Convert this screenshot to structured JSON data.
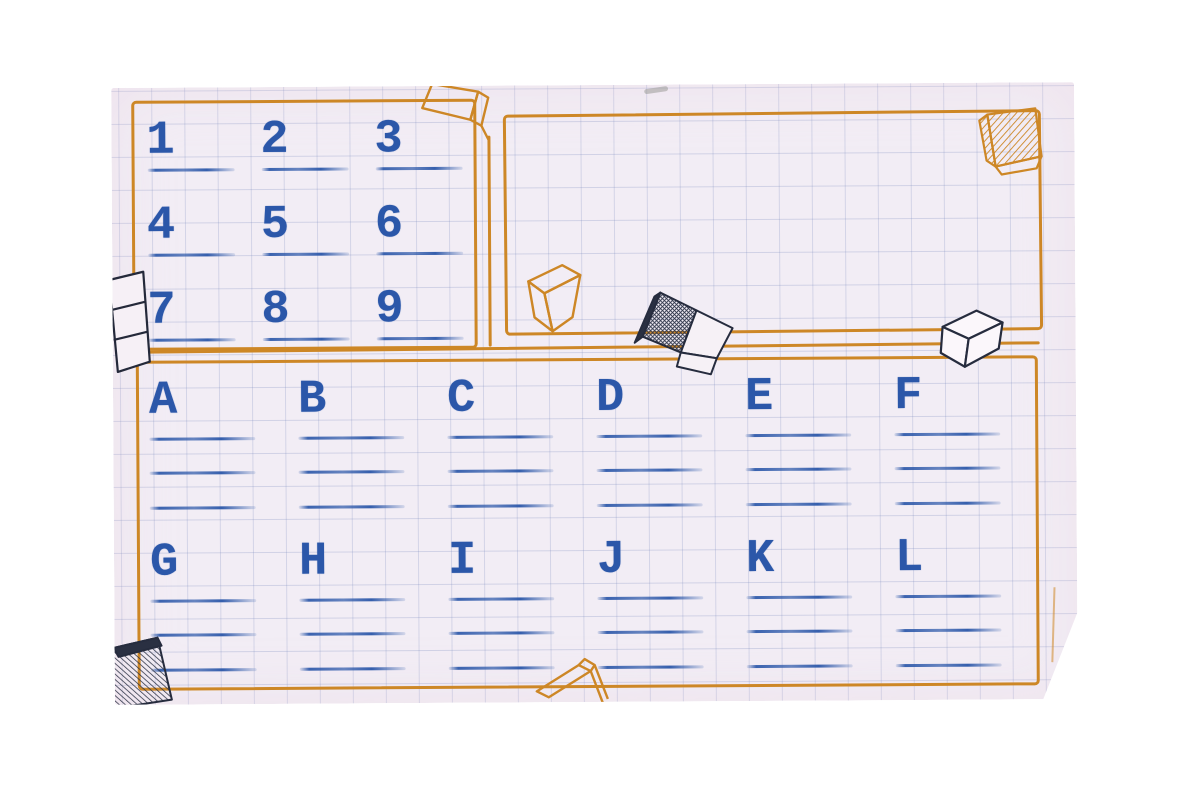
{
  "palette": {
    "paper": "#f2edf5",
    "grid_line": "#7a8abd",
    "ink_orange": "#cd8726",
    "ink_blue": "#2b57a9",
    "ink_dark": "#262c3e",
    "background": "#ffffff"
  },
  "number_panel": {
    "answer_lines_per_cell": 1,
    "cells": [
      {
        "label": "1"
      },
      {
        "label": "2"
      },
      {
        "label": "3"
      },
      {
        "label": "4"
      },
      {
        "label": "5"
      },
      {
        "label": "6"
      },
      {
        "label": "7"
      },
      {
        "label": "8"
      },
      {
        "label": "9"
      }
    ]
  },
  "letter_panel": {
    "answer_lines_per_cell": 3,
    "cells": [
      {
        "label": "A"
      },
      {
        "label": "B"
      },
      {
        "label": "C"
      },
      {
        "label": "D"
      },
      {
        "label": "E"
      },
      {
        "label": "F"
      },
      {
        "label": "G"
      },
      {
        "label": "H"
      },
      {
        "label": "I"
      },
      {
        "label": "J"
      },
      {
        "label": "K"
      },
      {
        "label": "L"
      }
    ]
  },
  "decorations": {
    "cubes": [
      "orange-cube-outline-top",
      "orange-cube-hatched-top-right",
      "orange-cube-outline-middle",
      "dark-hatched-eraser-block-middle",
      "white-cube-right",
      "white-block-left-edge",
      "dark-hatched-block-bottom-left",
      "orange-cube-outline-bottom"
    ]
  }
}
